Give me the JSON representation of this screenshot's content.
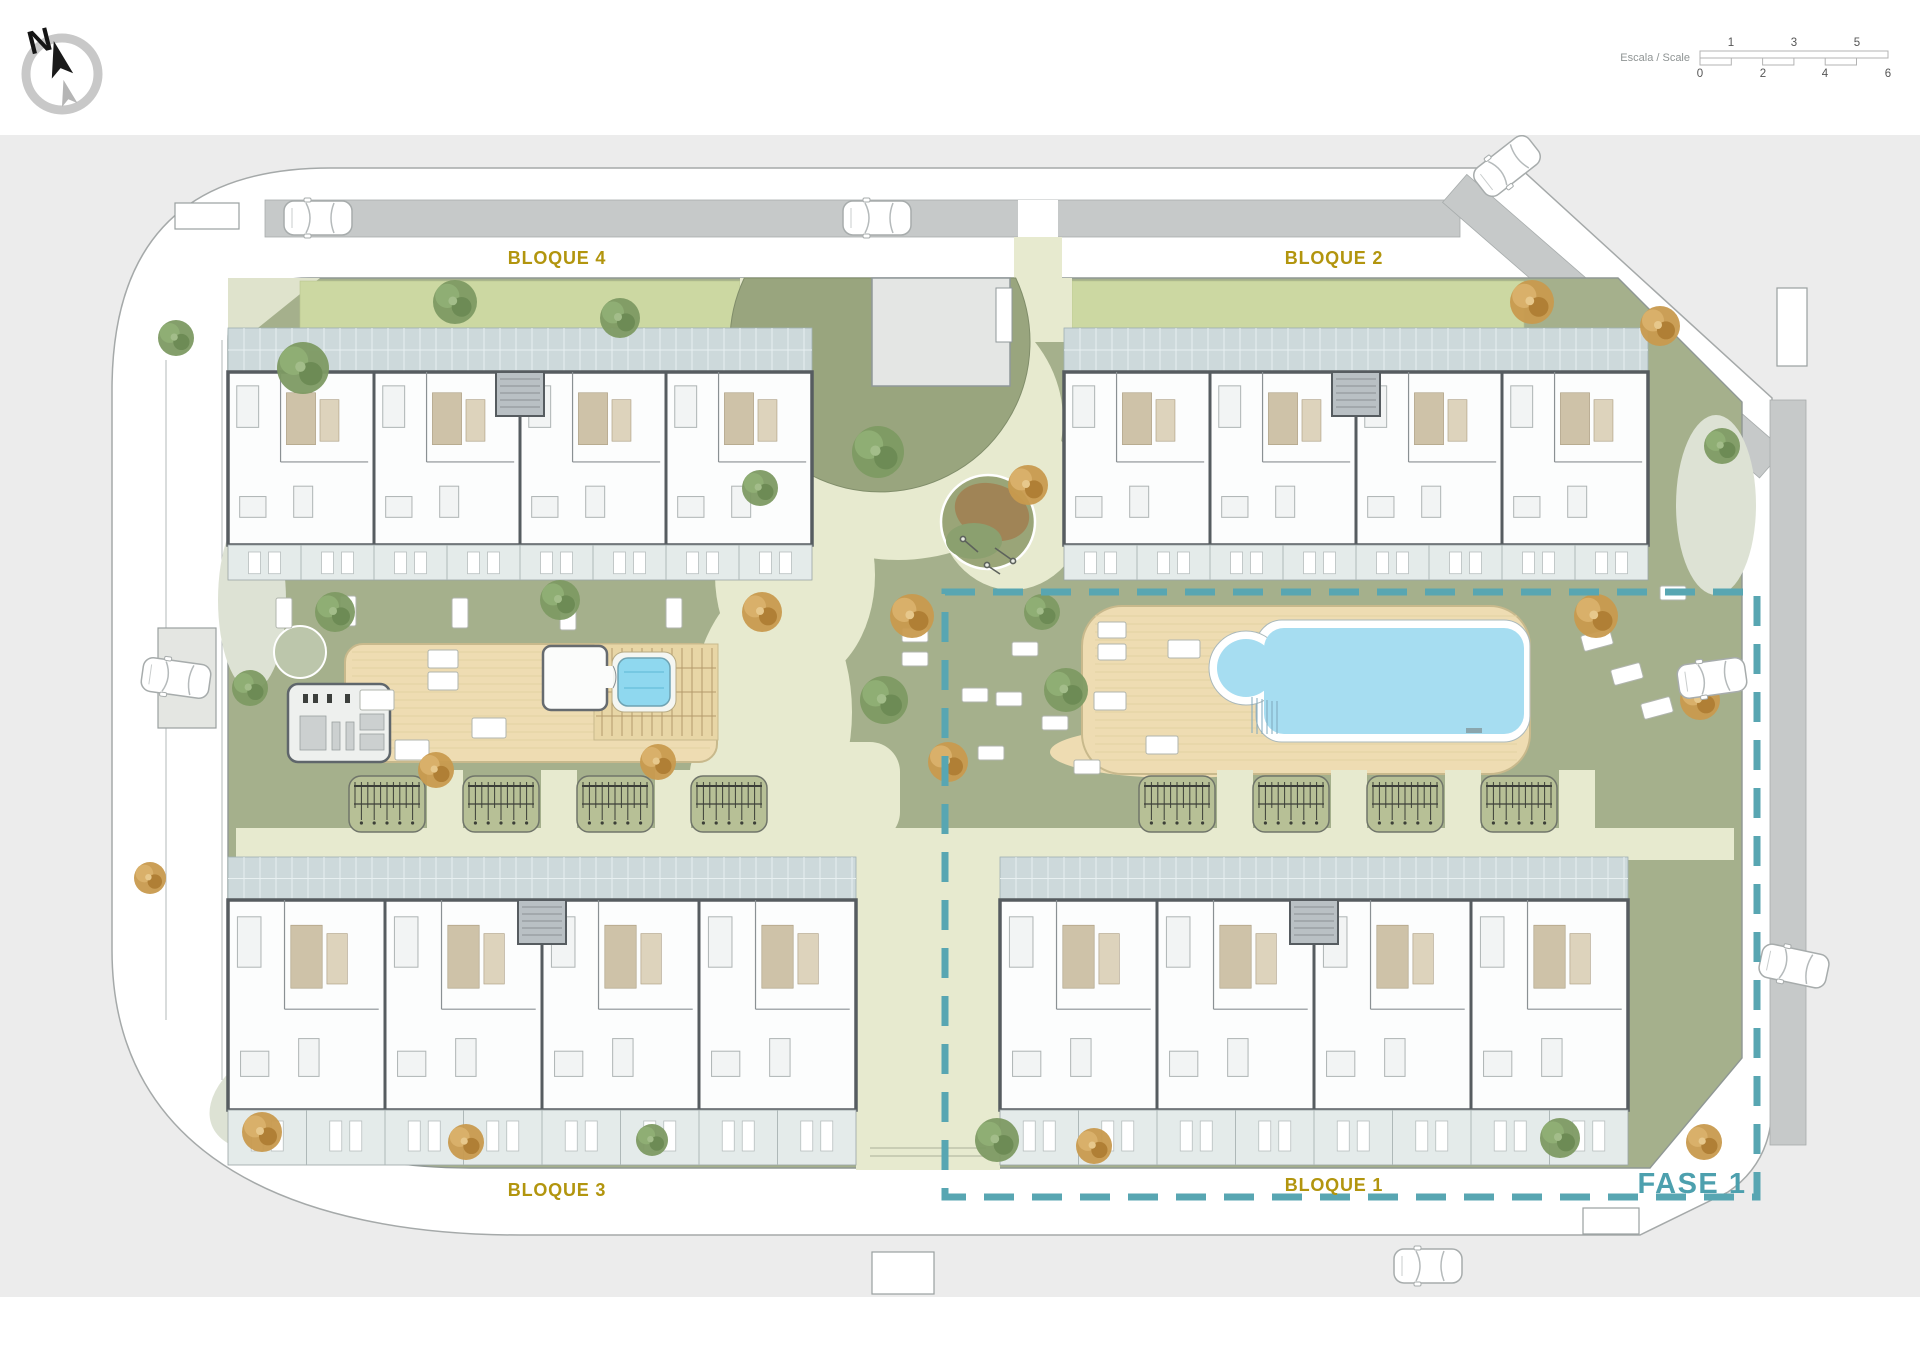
{
  "compass": {
    "icon": "compass-north-icon",
    "label": "N"
  },
  "scale_bar": {
    "label": "Escala / Scale",
    "top_ticks": [
      "1",
      "3",
      "5"
    ],
    "bottom_ticks": [
      "0",
      "2",
      "4",
      "6"
    ]
  },
  "blocks": [
    {
      "id": "bloque-4",
      "label": "BLOQUE 4"
    },
    {
      "id": "bloque-2",
      "label": "BLOQUE 2"
    },
    {
      "id": "bloque-3",
      "label": "BLOQUE 3"
    },
    {
      "id": "bloque-1",
      "label": "BLOQUE 1"
    }
  ],
  "phase": {
    "label": "FASE 1"
  },
  "features": {
    "pool": "swimming-pool-icon",
    "spa": "jacuzzi-icon",
    "gym": "gym-room-icon",
    "playground": "playground-icon",
    "pergolas": "parking-pergola-icon",
    "cars": "car-icon",
    "trees": "tree-icon"
  },
  "palette": {
    "canvas": "#ececec",
    "road_band": "#c6c9c9",
    "lawn": "#a5b08c",
    "lawn_dark": "#99a57e",
    "path_cream": "#e7eacf",
    "path_soft": "#dde2d4",
    "planting_strip": "#ccd8a2",
    "deck": "#eedcb2",
    "pool_water": "#a6ddf1",
    "tile_walkway": "#cdd9db",
    "terrace": "#e4ebea",
    "wall": "#565c60",
    "bath_beige": "#cec2a8",
    "tree_green": "#7d9a63",
    "tree_orange": "#c89a4e",
    "gold": "#b2950e",
    "teal": "#4da0ae"
  }
}
